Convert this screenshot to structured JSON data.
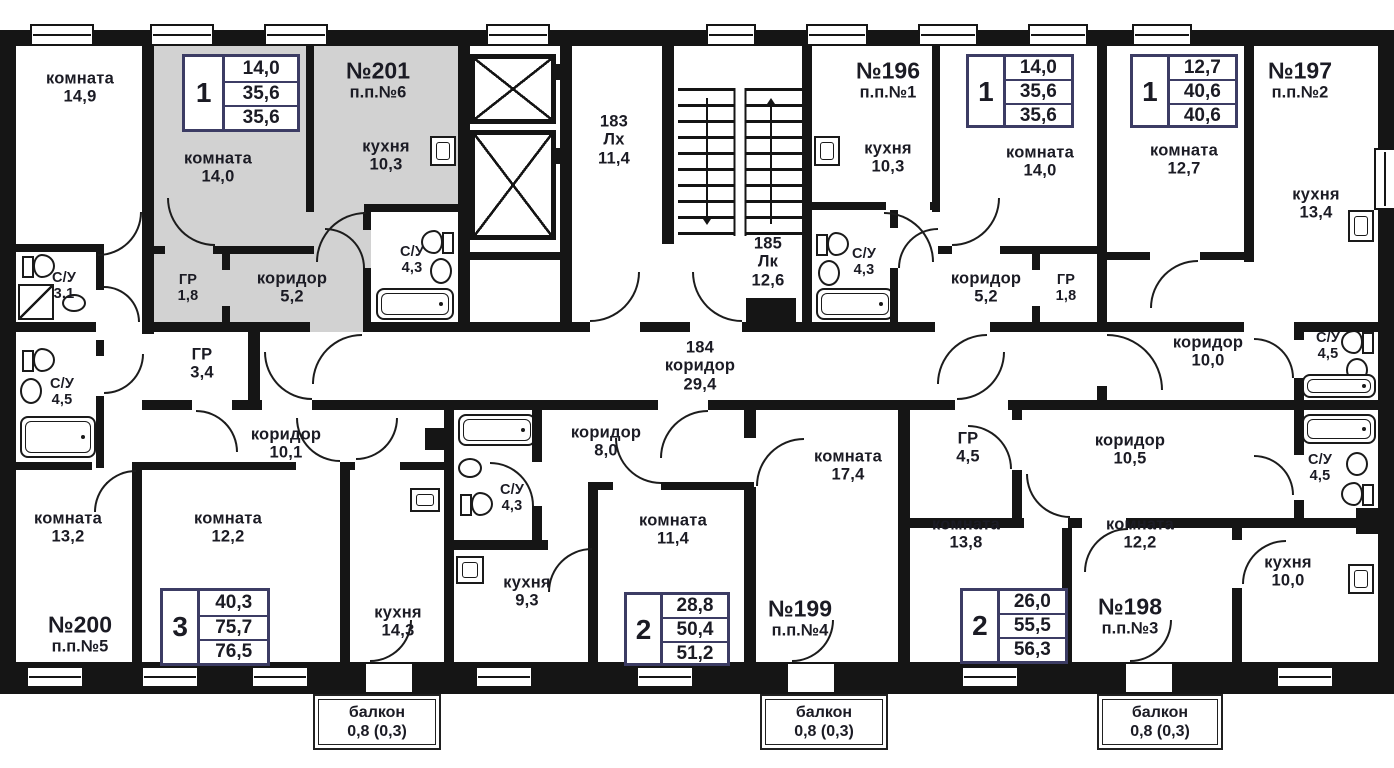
{
  "colors": {
    "wall": "#151515",
    "highlight": "#d2d2d2",
    "accent": "#3c3c64",
    "text": "#1b1b24"
  },
  "apartments": {
    "a200": {
      "number": "№200",
      "entry": "п.п.№5",
      "rooms_count": "3",
      "spec": [
        "40,3",
        "75,7",
        "76,5"
      ]
    },
    "a201": {
      "number": "№201",
      "entry": "п.п.№6",
      "rooms_count": "1",
      "spec": [
        "14,0",
        "35,6",
        "35,6"
      ]
    },
    "a196": {
      "number": "№196",
      "entry": "п.п.№1",
      "rooms_count": "1",
      "spec": [
        "14,0",
        "35,6",
        "35,6"
      ]
    },
    "a197": {
      "number": "№197",
      "entry": "п.п.№2",
      "rooms_count": "1",
      "spec": [
        "12,7",
        "40,6",
        "40,6"
      ]
    },
    "a199": {
      "number": "№199",
      "entry": "п.п.№4",
      "rooms_count": "2",
      "spec": [
        "28,8",
        "50,4",
        "51,2"
      ]
    },
    "a198": {
      "number": "№198",
      "entry": "п.п.№3",
      "rooms_count": "2",
      "spec": [
        "26,0",
        "55,5",
        "56,3"
      ]
    }
  },
  "rooms": {
    "room_149": {
      "name": "комната",
      "area": "14,9"
    },
    "su_31": {
      "name": "С/У",
      "area": "3,1"
    },
    "su_45_left": {
      "name": "С/У",
      "area": "4,5"
    },
    "gr_34": {
      "name": "ГР",
      "area": "3,4"
    },
    "cor_101": {
      "name": "коридор",
      "area": "10,1"
    },
    "room_132": {
      "name": "комната",
      "area": "13,2"
    },
    "room_122_left": {
      "name": "комната",
      "area": "12,2"
    },
    "kit_143": {
      "name": "кухня",
      "area": "14,3"
    },
    "room_140_201": {
      "name": "комната",
      "area": "14,0"
    },
    "kit_103_201": {
      "name": "кухня",
      "area": "10,3"
    },
    "su_43_201": {
      "name": "С/У",
      "area": "4,3"
    },
    "gr_18_201": {
      "name": "ГР",
      "area": "1,8"
    },
    "cor_52_201": {
      "name": "коридор",
      "area": "5,2"
    },
    "kit_103_196": {
      "name": "кухня",
      "area": "10,3"
    },
    "su_43_196": {
      "name": "С/У",
      "area": "4,3"
    },
    "cor_52_196": {
      "name": "коридор",
      "area": "5,2"
    },
    "gr_18_196": {
      "name": "ГР",
      "area": "1,8"
    },
    "room_140_196": {
      "name": "комната",
      "area": "14,0"
    },
    "room_127": {
      "name": "комната",
      "area": "12,7"
    },
    "kit_134": {
      "name": "кухня",
      "area": "13,4"
    },
    "cor_100": {
      "name": "коридор",
      "area": "10,0"
    },
    "su_45_197": {
      "name": "С/У",
      "area": "4,5"
    },
    "cor_80": {
      "name": "коридор",
      "area": "8,0"
    },
    "su_43_199": {
      "name": "С/У",
      "area": "4,3"
    },
    "kit_93": {
      "name": "кухня",
      "area": "9,3"
    },
    "room_114": {
      "name": "комната",
      "area": "11,4"
    },
    "room_174": {
      "name": "комната",
      "area": "17,4"
    },
    "gr_45_198": {
      "name": "ГР",
      "area": "4,5"
    },
    "cor_105": {
      "name": "коридор",
      "area": "10,5"
    },
    "su_45_198": {
      "name": "С/У",
      "area": "4,5"
    },
    "room_138": {
      "name": "комната",
      "area": "13,8"
    },
    "room_122_198": {
      "name": "комната",
      "area": "12,2"
    },
    "kit_100": {
      "name": "кухня",
      "area": "10,0"
    }
  },
  "common": {
    "elevator_hall": {
      "id": "183",
      "abbr": "Лх",
      "area": "11,4"
    },
    "stairwell": {
      "id": "185",
      "abbr": "Лк",
      "area": "12,6"
    },
    "corridor": {
      "id": "184",
      "name": "коридор",
      "area": "29,4"
    },
    "balcony": {
      "name": "балкон",
      "area": "0,8 (0,3)"
    }
  }
}
